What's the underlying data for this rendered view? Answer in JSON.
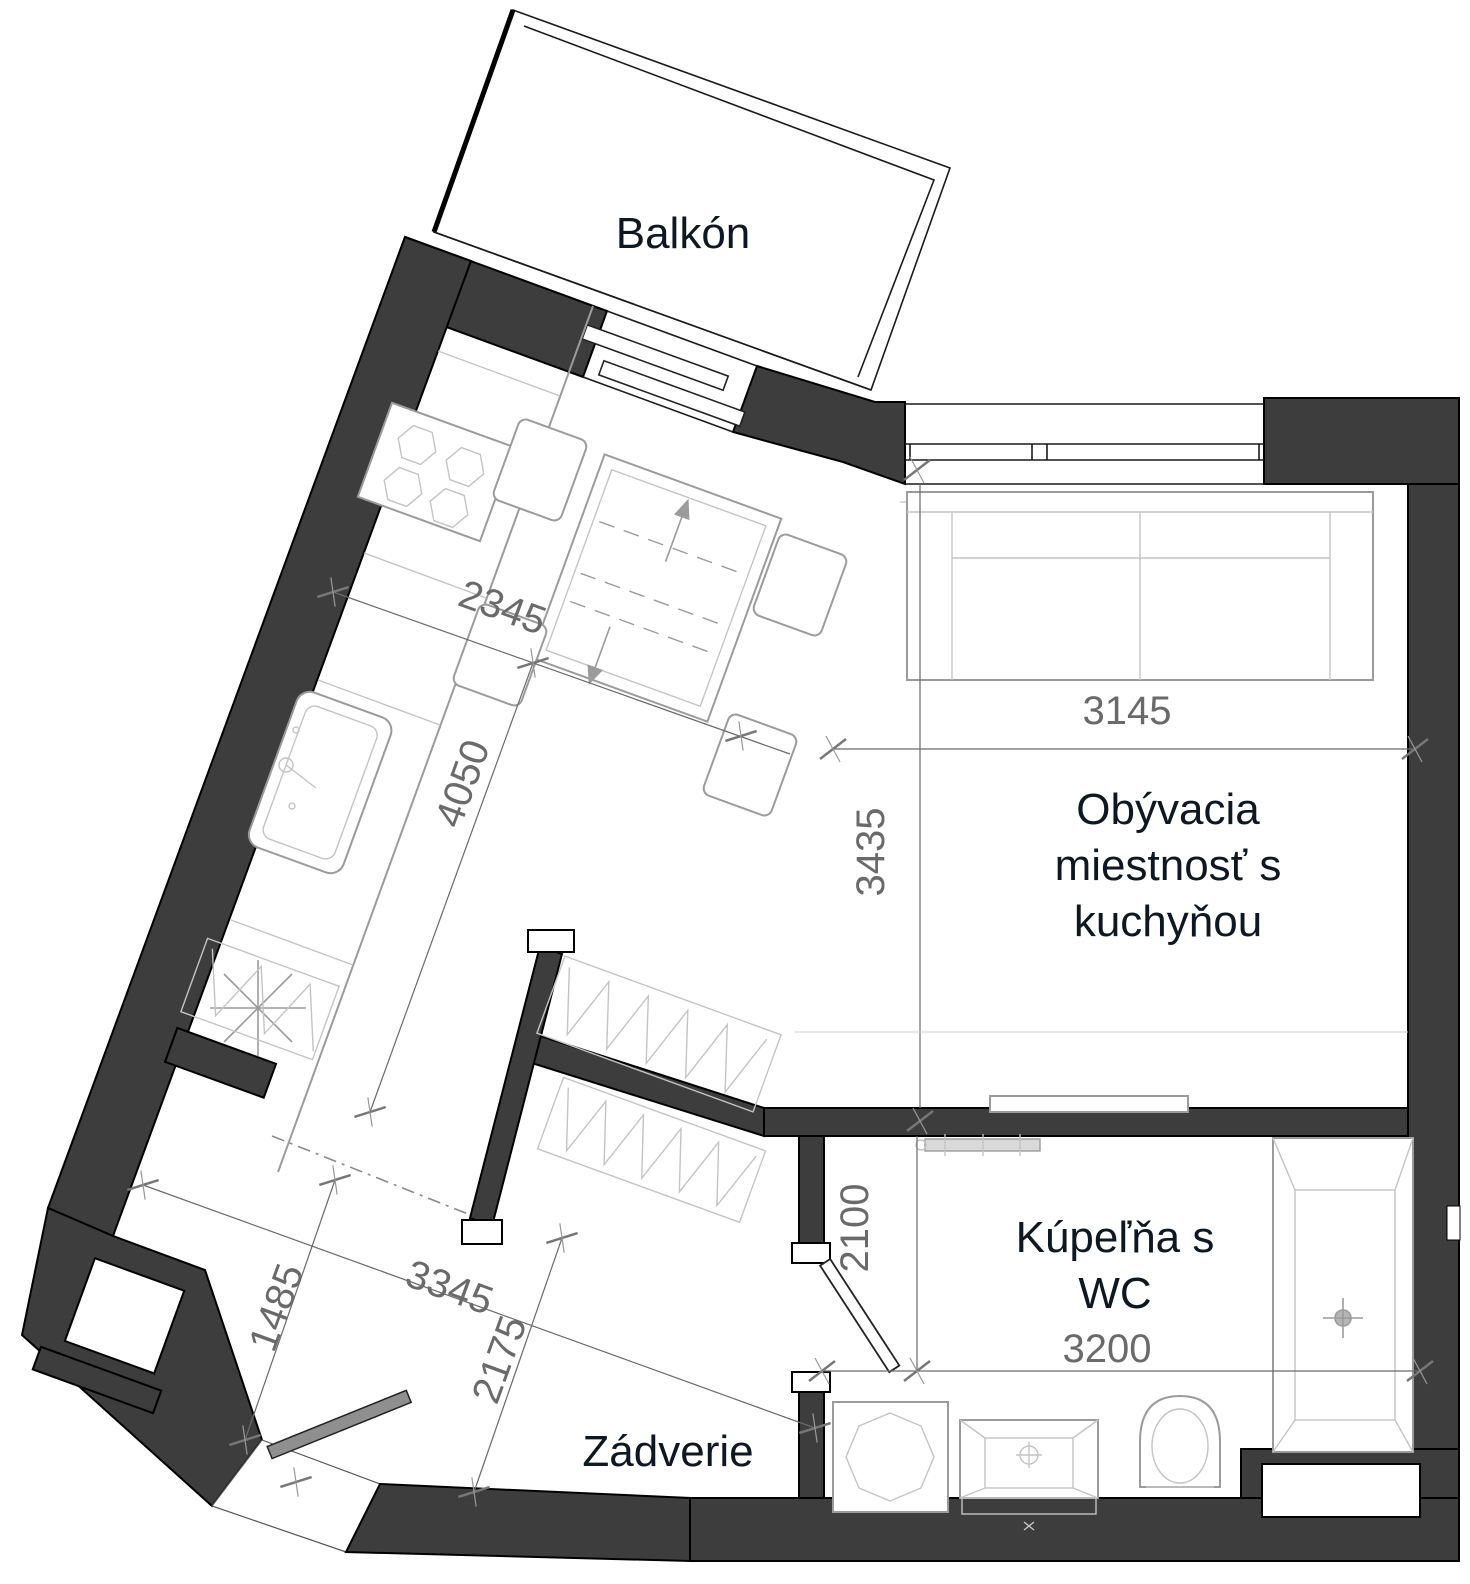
{
  "plan": {
    "rooms": {
      "balcony": "Balkón",
      "living_line1": "Obývacia",
      "living_line2": "miestnosť s",
      "living_line3": "kuchyňou",
      "bath_line1": "Kúpeľňa s",
      "bath_line2": "WC",
      "hall": "Zádverie"
    },
    "dimensions": {
      "kitchen_width": "2345",
      "kitchen_length": "4050",
      "living_width": "3145",
      "living_depth": "3435",
      "hall_width": "3345",
      "hall_niche": "1485",
      "hall_length": "2175",
      "bath_depth": "2100",
      "bath_width": "3200"
    },
    "colors": {
      "wall": "#3d3d3d",
      "room_label": "#0f1721",
      "dimension": "#6a6a6a",
      "furniture": "#9b9b9b",
      "furniture_light": "#c4c4c4"
    }
  }
}
